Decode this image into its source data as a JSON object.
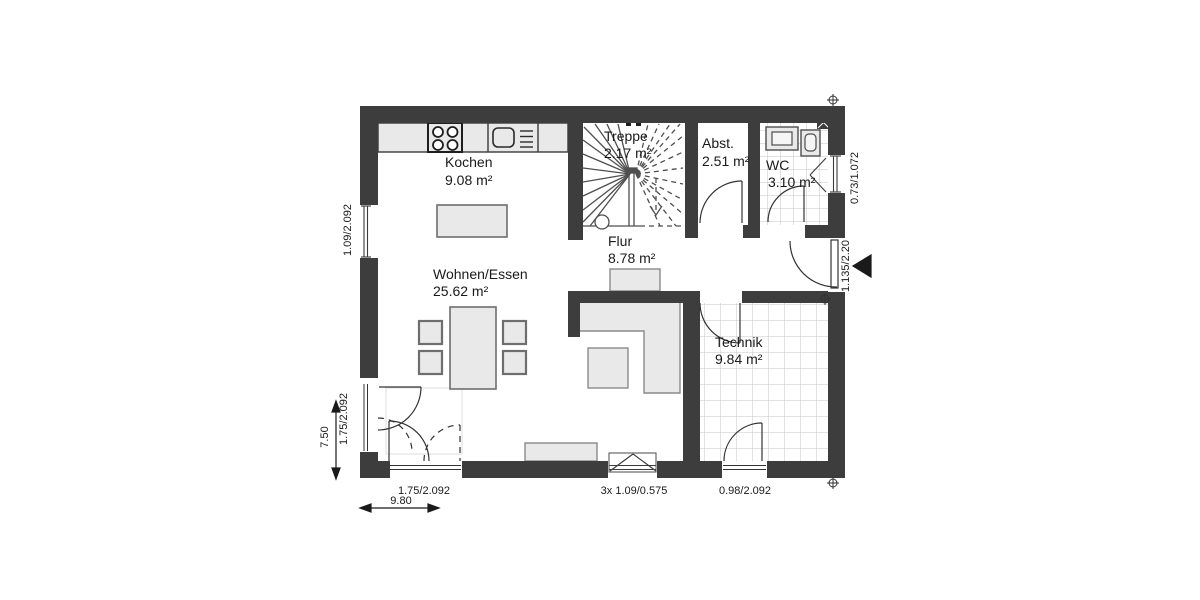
{
  "plan": {
    "rooms": [
      {
        "name": "Kochen",
        "area": "9.08 m²"
      },
      {
        "name": "Treppe",
        "area": "2.17 m²"
      },
      {
        "name": "Abst.",
        "area": "2.51 m²"
      },
      {
        "name": "WC",
        "area": "3.10 m²"
      },
      {
        "name": "Flur",
        "area": "8.78 m²"
      },
      {
        "name": "Wohnen/Essen",
        "area": "25.62 m²"
      },
      {
        "name": "Technik",
        "area": "9.84 m²"
      }
    ],
    "dims": {
      "left_window": "1.09/2.092",
      "left_door": "1.75/2.092",
      "left_height": "7.50",
      "wc_window": "0.73/1.072",
      "entrance": "1.135/2.20",
      "terrace_door": "1.75/2.092",
      "triple_window": "3x 1.09/0.575",
      "technik_door": "0.98/2.092",
      "bottom_width": "9.80"
    },
    "colors": {
      "wall": "#3d3d3d",
      "furniture": "#e9e9e9",
      "tile": "#c6c6c6"
    }
  }
}
